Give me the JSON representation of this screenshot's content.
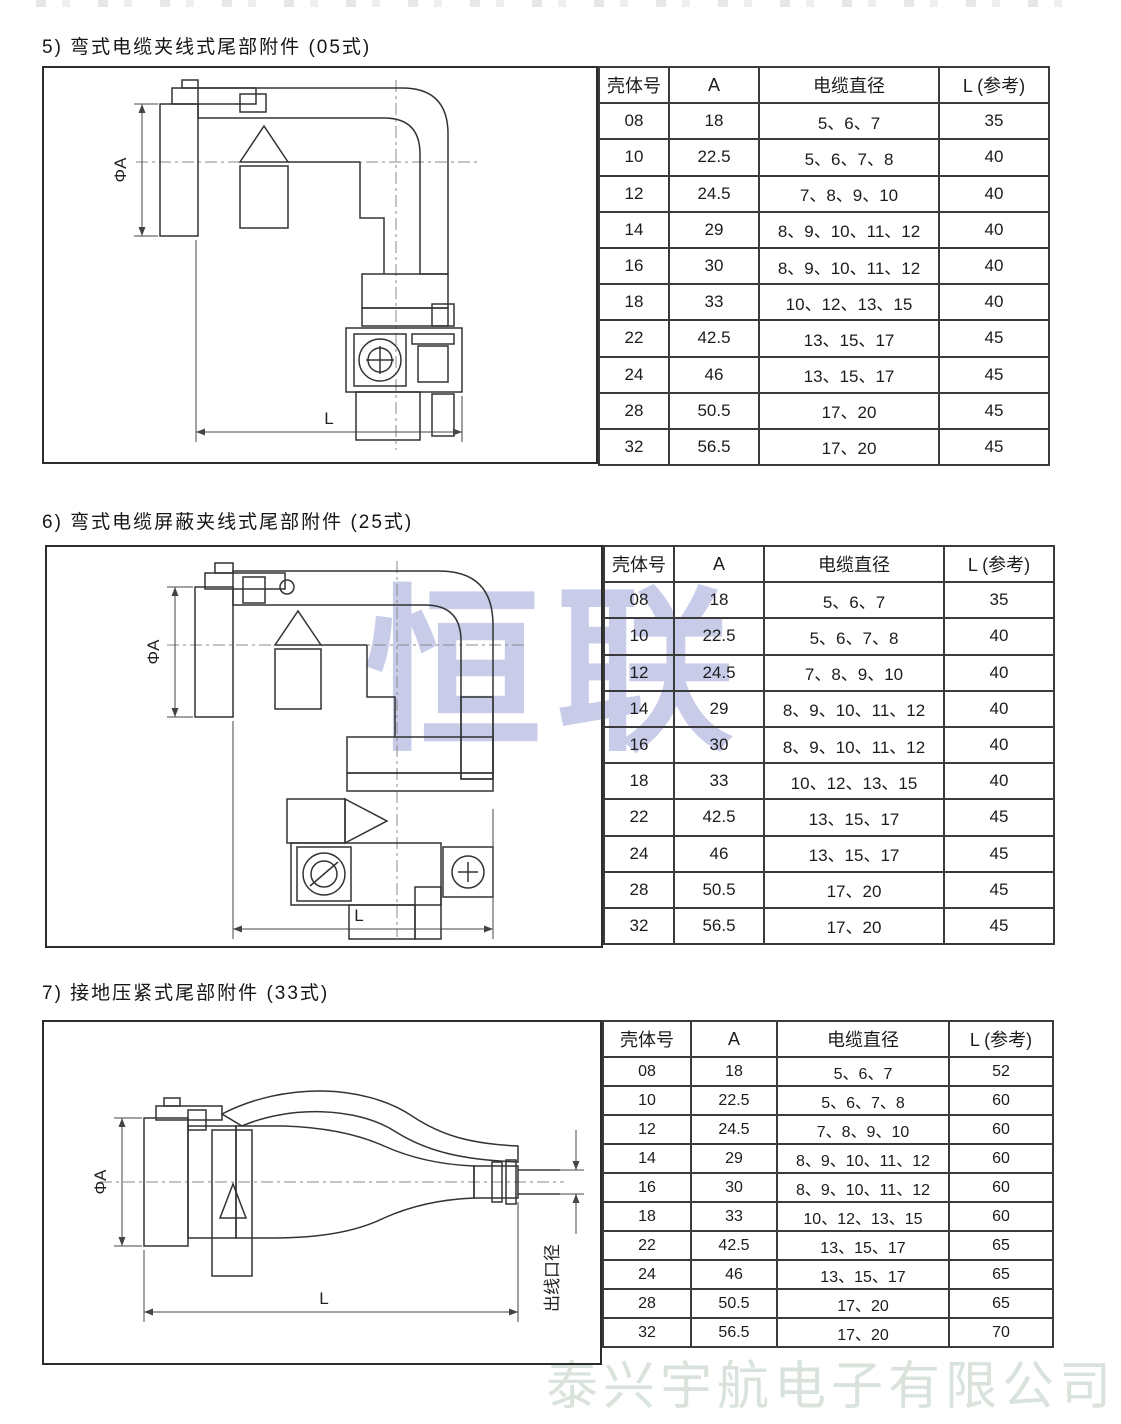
{
  "page": {
    "center_watermark": "恒联",
    "footer_watermark": "泰兴宇航电子有限公司"
  },
  "sections": [
    {
      "title": "5) 弯式电缆夹线式尾部附件 (05式)",
      "drawing": {
        "dia_label": "ΦA",
        "length_label": "L"
      },
      "table": {
        "headers": [
          "壳体号",
          "A",
          "电缆直径",
          "L (参考)"
        ],
        "rows": [
          [
            "08",
            "18",
            "5、6、7",
            "35"
          ],
          [
            "10",
            "22.5",
            "5、6、7、8",
            "40"
          ],
          [
            "12",
            "24.5",
            "7、8、9、10",
            "40"
          ],
          [
            "14",
            "29",
            "8、9、10、11、12",
            "40"
          ],
          [
            "16",
            "30",
            "8、9、10、11、12",
            "40"
          ],
          [
            "18",
            "33",
            "10、12、13、15",
            "40"
          ],
          [
            "22",
            "42.5",
            "13、15、17",
            "45"
          ],
          [
            "24",
            "46",
            "13、15、17",
            "45"
          ],
          [
            "28",
            "50.5",
            "17、20",
            "45"
          ],
          [
            "32",
            "56.5",
            "17、20",
            "45"
          ]
        ]
      }
    },
    {
      "title": "6) 弯式电缆屏蔽夹线式尾部附件 (25式)",
      "drawing": {
        "dia_label": "ΦA",
        "length_label": "L"
      },
      "table": {
        "headers": [
          "壳体号",
          "A",
          "电缆直径",
          "L (参考)"
        ],
        "rows": [
          [
            "08",
            "18",
            "5、6、7",
            "35"
          ],
          [
            "10",
            "22.5",
            "5、6、7、8",
            "40"
          ],
          [
            "12",
            "24.5",
            "7、8、9、10",
            "40"
          ],
          [
            "14",
            "29",
            "8、9、10、11、12",
            "40"
          ],
          [
            "16",
            "30",
            "8、9、10、11、12",
            "40"
          ],
          [
            "18",
            "33",
            "10、12、13、15",
            "40"
          ],
          [
            "22",
            "42.5",
            "13、15、17",
            "45"
          ],
          [
            "24",
            "46",
            "13、15、17",
            "45"
          ],
          [
            "28",
            "50.5",
            "17、20",
            "45"
          ],
          [
            "32",
            "56.5",
            "17、20",
            "45"
          ]
        ]
      }
    },
    {
      "title": "7) 接地压紧式尾部附件 (33式)",
      "drawing": {
        "dia_label": "ΦA",
        "length_label": "L",
        "exit_label": "出线口径"
      },
      "table": {
        "headers": [
          "壳体号",
          "A",
          "电缆直径",
          "L (参考)"
        ],
        "rows": [
          [
            "08",
            "18",
            "5、6、7",
            "52"
          ],
          [
            "10",
            "22.5",
            "5、6、7、8",
            "60"
          ],
          [
            "12",
            "24.5",
            "7、8、9、10",
            "60"
          ],
          [
            "14",
            "29",
            "8、9、10、11、12",
            "60"
          ],
          [
            "16",
            "30",
            "8、9、10、11、12",
            "60"
          ],
          [
            "18",
            "33",
            "10、12、13、15",
            "60"
          ],
          [
            "22",
            "42.5",
            "13、15、17",
            "65"
          ],
          [
            "24",
            "46",
            "13、15、17",
            "65"
          ],
          [
            "28",
            "50.5",
            "17、20",
            "65"
          ],
          [
            "32",
            "56.5",
            "17、20",
            "70"
          ]
        ]
      }
    }
  ]
}
